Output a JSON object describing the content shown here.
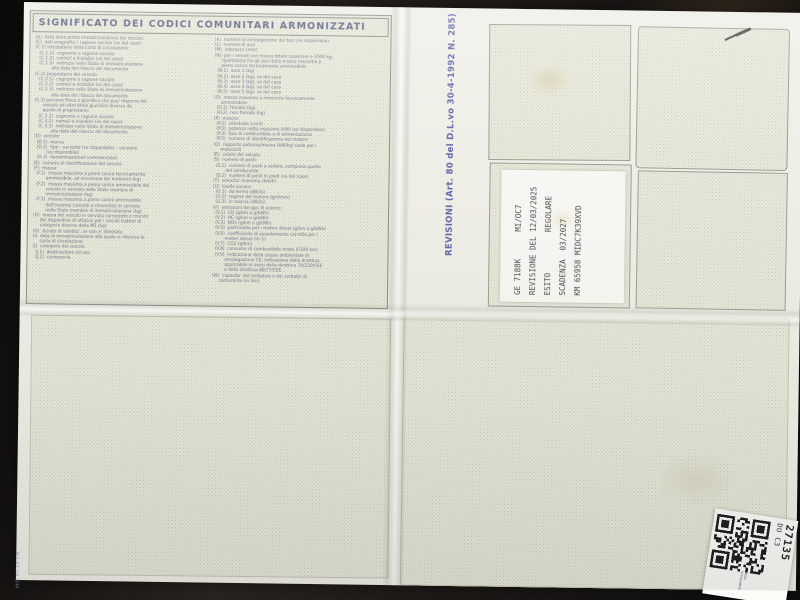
{
  "legend": {
    "title": "SIGNIFICATO DEI CODICI COMUNITARI ARMONIZZATI",
    "left_column": [
      "(B)  data della prima immatricolazione del veicolo",
      "(C)  dati anagrafici / ragione sociale (se del caso)",
      "(C.1) intestatario della carta di circolazione:",
      "   (C.1.1)  cognome o ragione sociale",
      "   (C.1.2)  nome/i e iniziale/i (se del caso)",
      "   (C.1.3)  indirizzo nello Stato di immatricolazione",
      "            alla data del rilascio del documento",
      "(C.2) proprietario del veicolo:",
      "   (C.2.1)  cognome o ragione sociale",
      "   (C.2.2)  nome/i e iniziale/i (se del caso)",
      "   (C.2.3)  indirizzo nello Stato di immatricolazione",
      "            alla data del rilascio del documento",
      "(C.3) persona fisica o giuridica che puo' disporre del",
      "      veicolo ad altro titolo giuridico diverso da",
      "      quello di proprietario:",
      "   (C.3.1)  cognome o ragione sociale",
      "   (C.3.2)  nome/i e iniziale/i (se del caso)",
      "   (C.3.3)  indirizzo nello Stato di immatricolazione",
      "            alla data del rilascio del documento",
      "(D)  veicolo:",
      "  (D.1)  marca",
      "  (D.2)  tipo - variante (se disponibile) - versione",
      "         (se disponibile)",
      "  (D.3)  denominazione/i commerciale/i",
      "(E)  numero di identificazione del veicolo",
      "(F)  massa:",
      "  (F.1)  massa massima a pieno carico tecnicamente",
      "         ammissibile, ad eccezione dei motocicli (kg)",
      "  (F.2)  massa massima a pieno carico ammissibile del",
      "         veicolo in servizio nello Stato membro di",
      "         immatricolazione (kg)",
      "  (F.3)  massa massima a pieno carico ammissibile",
      "         dell'insieme (veicolo e rimorchio) in servizio",
      "         nello Stato membro di immatricolazione (kg)",
      "(G)  massa del veicolo in servizio carrozzato e munito",
      "     del dispositivo di attacco per i veicoli trattori di",
      "     categoria diversa dalla M1 (kg)",
      "(H)  durata di validita', se non e' illimitata",
      "(I)  data di immatricolazione alla quale si riferisce la",
      "     carta di circolazione",
      "(J)  categoria del veicolo",
      "  (J.1)  destinazione ed uso",
      "  (J.2)  carrozzeria"
    ],
    "right_column": [
      "(K)  numero di omologazione del tipo (se disponibile)",
      "(L)  numero di assi",
      "(M)  interasse (mm)",
      "(N)  per i veicoli con massa totale superiore a 3500 kg,",
      "     ripartizione fra gli assi della massa massima a",
      "     pieno carico tecnicamente ammissibile:",
      "  (N.1)  asse 1 (kg)",
      "  (N.2)  asse 2 (kg), se del caso",
      "  (N.3)  asse 3 (kg), se del caso",
      "  (N.4)  asse 4 (kg), se del caso",
      "  (N.5)  asse 5 (kg), se del caso",
      "(O)  massa massima a rimorchio tecnicamente",
      "     ammissibile:",
      "  (O.1)  frenato (kg)",
      "  (O.2)  non frenato (kg)",
      "(P)  motore:",
      "  (P.1)  cilindrata (cm3)",
      "  (P.2)  potenza netta massima (kW) (se disponibile)",
      "  (P.3)  tipo di combustibile o di alimentazione",
      "  (P.5)  numero di identificazione del motore",
      "(Q)  rapporto potenza/massa (kW/kg) (solo per i",
      "     motocicli)",
      "(R)  colore del veicolo",
      "(S)  numero di posti:",
      "  (S.1)  numero di posti a sedere, compreso quello",
      "         del conducente",
      "  (S.2)  numero di posti in piedi (se del caso)",
      "(T)  velocita' massima (km/h)",
      "(U)  livello sonoro:",
      "  (U.1)  da fermo (dB(A))",
      "  (U.2)  regime del motore (giri/min)",
      "  (U.3)  in marcia (dB(A))",
      "(V)  emissioni dei gas di scarico:",
      "  (V.1)  CO (g/km o g/kWh)",
      "  (V.2)  HC (g/km o g/kWh)",
      "  (V.3)  NOx (g/km o g/kWh)",
      "  (V.5)  particolato per i motori diesel (g/km o g/kWh)",
      "  (V.6)  coefficiente di assorbimento corretto per i",
      "         motori diesel (m-1)",
      "  (V.7)  CO2 (g/km)",
      "  (V.8)  consumo di combustibile misto (l/100 km)",
      "  (V.9)  indicazione della classe ambientale di",
      "         omologazione CE; indicazione della direttiva",
      "         applicabile ai sensi della direttiva 70/220/CEE",
      "         o della direttiva 88/77/CEE",
      "(W)  capacita' del serbatoio o dei serbatoi di",
      "     carburante (in litri)"
    ]
  },
  "revisioni": {
    "section_label": "REVISIONI (Art. 80 del D.L.vo 30-4-1992 N. 285)",
    "stamp": {
      "lines": [
        "GE 7188K      MI/OC7",
        "REVISIONE DEL 12/03/2025",
        "ESITO         REGOLARE",
        "SCADENZA  03/2027",
        "KM 65958 MIDC7K39XVD"
      ]
    }
  },
  "qr_sticker": {
    "code_primary": "27135",
    "code_secondary": "DU C3",
    "fine_print": [
      "ritiro",
      "rinnovabile"
    ]
  },
  "edge_code": "MIB 05 10 EM",
  "colors": {
    "paper": "#efeee7",
    "pattern_dot": "#8c9a6e",
    "legend_text": "#6e7488",
    "title_text": "#5a6282",
    "revisioni_label": "#6467ac",
    "stamp_ink": "#4b4c50",
    "background": "#161311"
  }
}
